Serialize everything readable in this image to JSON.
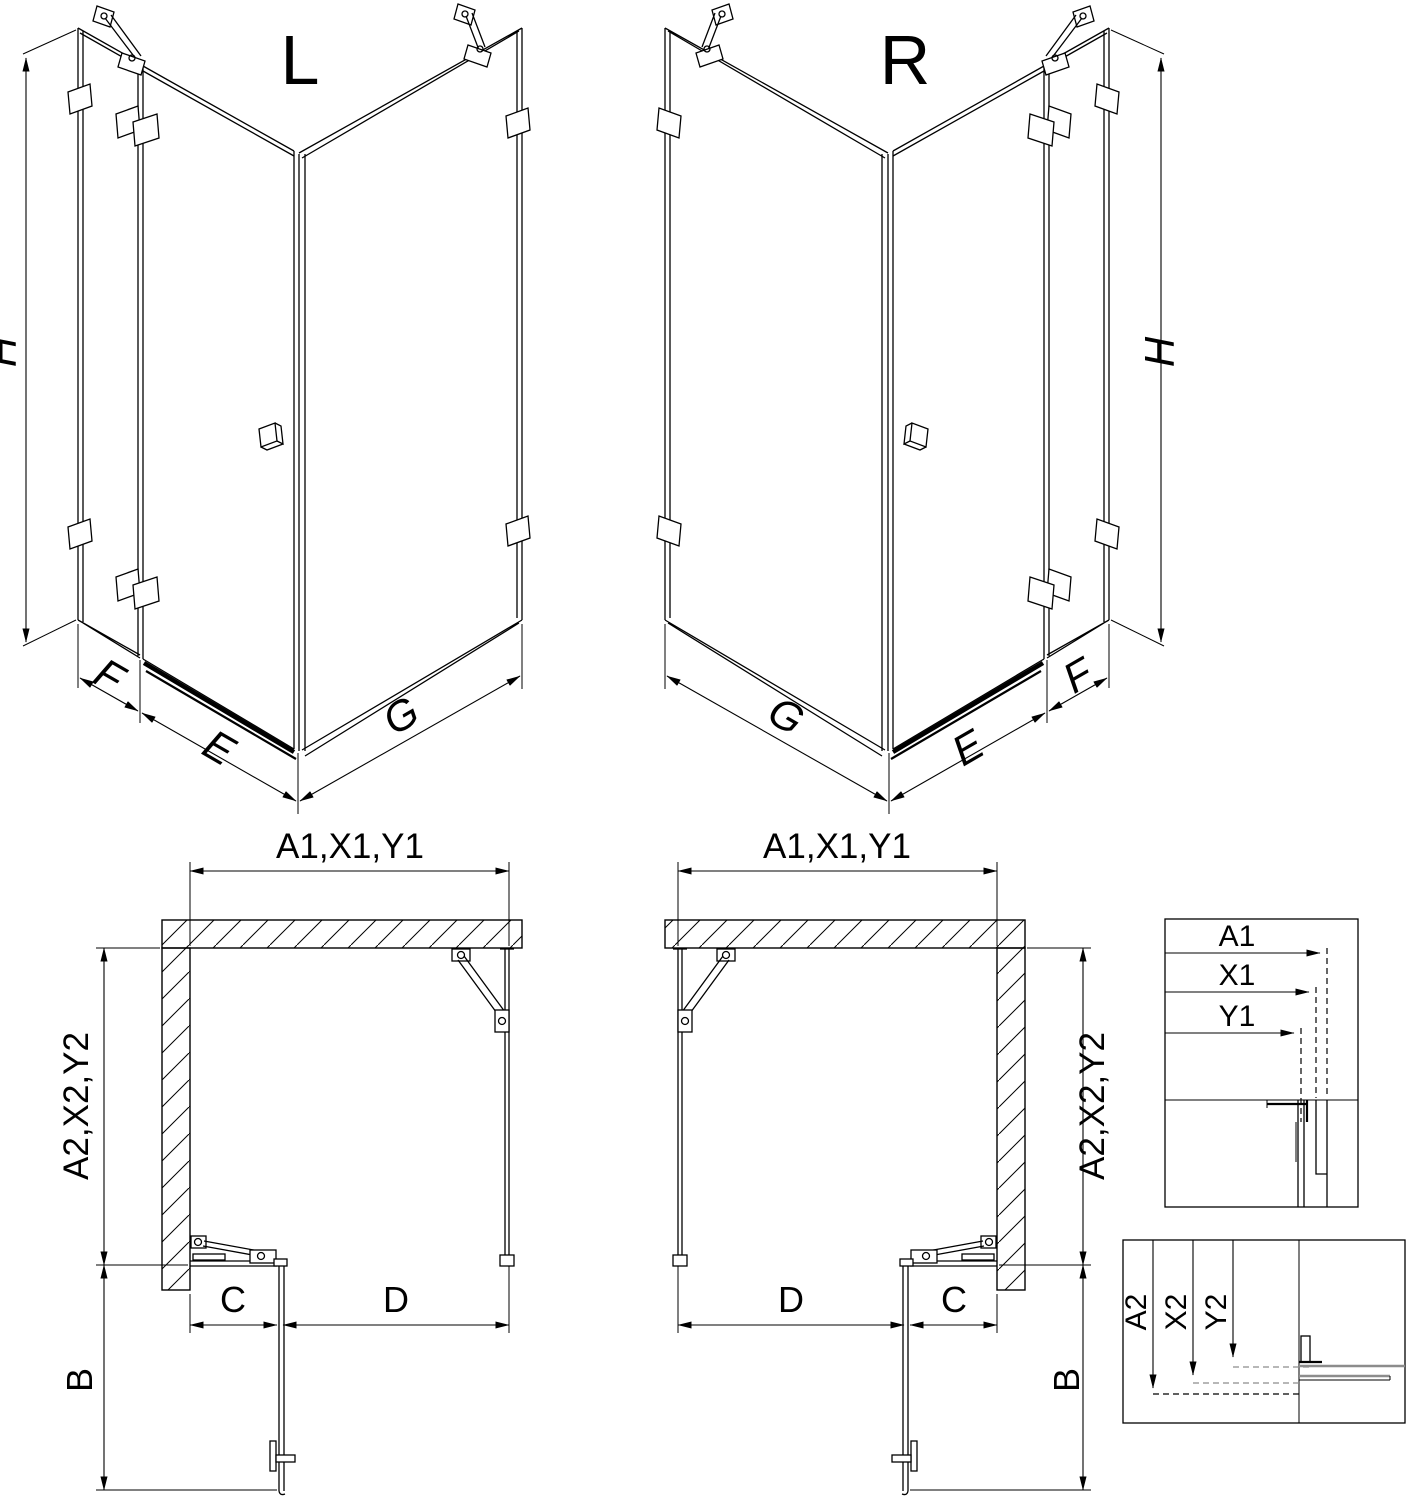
{
  "drawing": {
    "kind": "shower enclosure corner entry technical drawing",
    "views": {
      "iso_left": {
        "label": "L",
        "height_dim": "H",
        "side_panel_dim": "F",
        "door_dim": "E",
        "fixed_panel_dim": "G"
      },
      "iso_right": {
        "label": "R",
        "height_dim": "H",
        "side_panel_dim": "F",
        "door_dim": "E",
        "fixed_panel_dim": "G"
      },
      "plan_left": {
        "width_dims": "A1,X1,Y1",
        "depth_dims": "A2,X2,Y2",
        "door_projection_dim": "B",
        "fixed_front_dim": "C",
        "door_opening_dim": "D"
      },
      "plan_right": {
        "width_dims": "A1,X1,Y1",
        "depth_dims": "A2,X2,Y2",
        "door_projection_dim": "B",
        "fixed_front_dim": "C",
        "door_opening_dim": "D"
      },
      "detail_width": {
        "dims": [
          "A1",
          "X1",
          "Y1"
        ]
      },
      "detail_depth": {
        "dims": [
          "A2",
          "X2",
          "Y2"
        ]
      }
    },
    "colors": {
      "line": "#000000",
      "profile_gray": "#8c8c8c",
      "background": "#ffffff"
    }
  }
}
